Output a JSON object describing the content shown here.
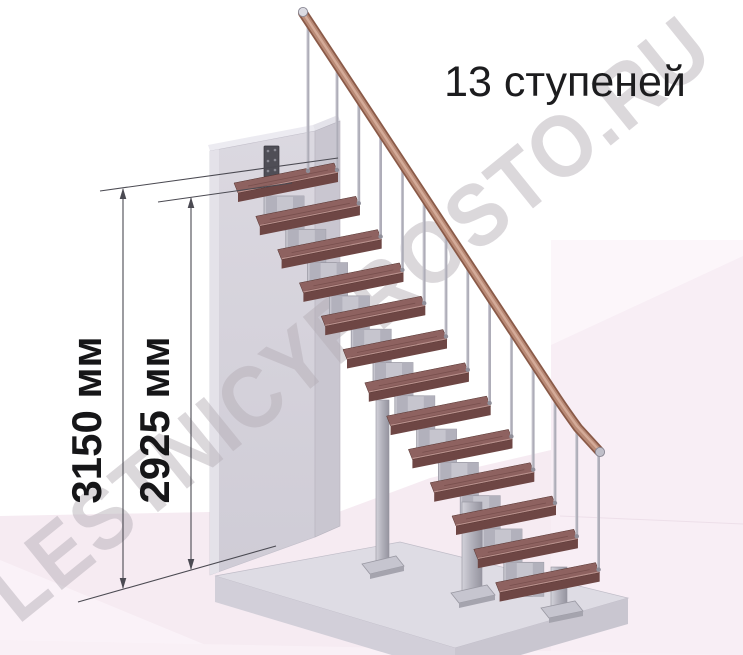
{
  "title": "13 ступеней",
  "steps_count": 13,
  "watermark": "LESTNICYPROSTO.RU",
  "dimensions": [
    {
      "label": "3150 мм",
      "value": 3150,
      "unit": "мм"
    },
    {
      "label": "2925 мм",
      "value": 2925,
      "unit": "мм"
    }
  ],
  "colors": {
    "tread_top": "#8e6260",
    "tread_front": "#6e4644",
    "tread_side": "#5d3937",
    "metal_light": "#c6c5ce",
    "metal_mid": "#b2b1bc",
    "metal_edge": "#94939e",
    "handrail_dark": "#8a5a48",
    "handrail_mid": "#b98a76",
    "handrail_light": "#d4ab99",
    "wall_front": "#d8d5dd",
    "wall_side": "#c9c6d0",
    "wall_top": "#ecebf1",
    "platform_top": "#dedce4",
    "platform_front_left": "#d2cfd9",
    "platform_front_right": "#c9c6d0",
    "floor_pink": "#f6ebf2",
    "floor_pink_right": "#faf1f7",
    "floor_pink_lighter": "#fcf6fa",
    "dimension_line": "#4b4a52",
    "mount_plate": "#4f4e56"
  }
}
